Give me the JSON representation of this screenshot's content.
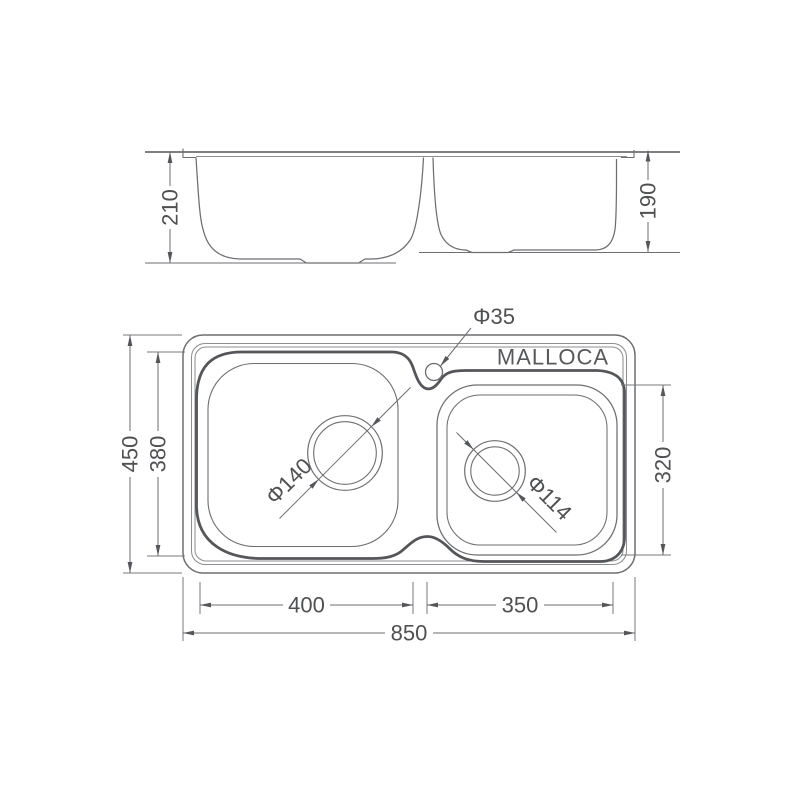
{
  "drawing": {
    "brand": "MALLOCA",
    "side_view": {
      "left_bowl_depth": "210",
      "right_bowl_depth": "190"
    },
    "plan_view": {
      "overall_length": "850",
      "overall_width": "450",
      "left_bowl_length": "400",
      "left_bowl_width": "380",
      "right_bowl_length": "350",
      "right_bowl_width": "320",
      "faucet_hole": "Φ35",
      "left_drain": "Φ140",
      "right_drain": "Φ114"
    },
    "colors": {
      "line": "#6d6e71",
      "thick_line": "#55565a",
      "text": "#4f5052"
    }
  }
}
